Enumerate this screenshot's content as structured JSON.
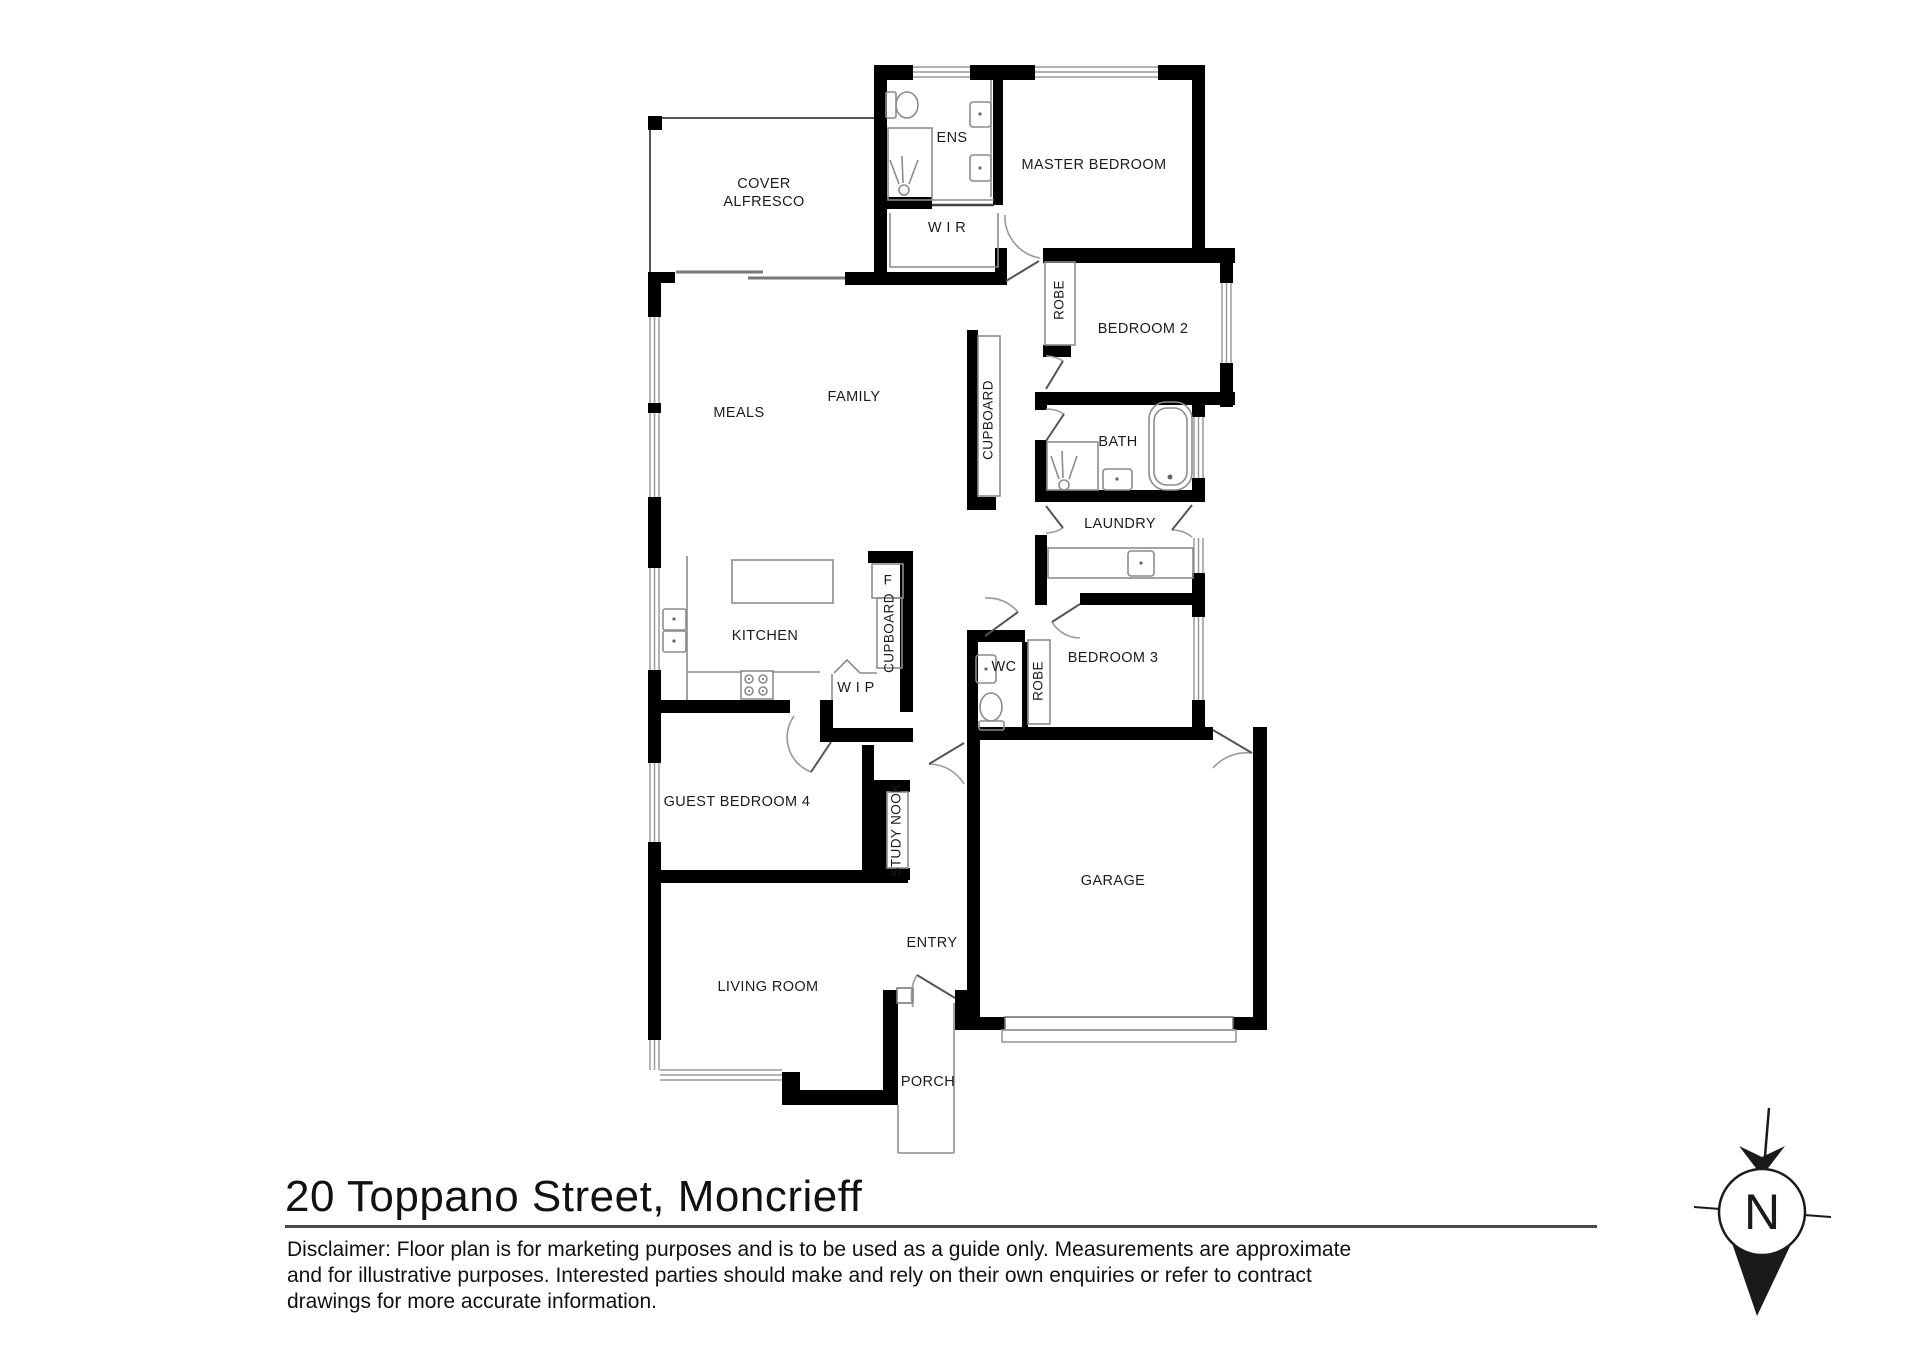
{
  "title": "20 Toppano Street, Moncrieff",
  "disclaimer": {
    "line1": "Disclaimer: Floor plan is for marketing purposes and is to be used as a guide only. Measurements  are approximate",
    "line2": "and for illustrative purposes. Interested parties should make and rely on their own enquiries or refer to contract",
    "line3": "drawings for more accurate information."
  },
  "compass": {
    "label": "N"
  },
  "rooms": {
    "cover_alfresco": "COVER\nALFRESCO",
    "ens": "ENS",
    "master_bedroom": "MASTER BEDROOM",
    "wir": "W I R",
    "robe_bedroom2": "ROBE",
    "bedroom2": "BEDROOM 2",
    "cupboard_hall": "CUPBOARD",
    "meals": "MEALS",
    "family": "FAMILY",
    "bath": "BATH",
    "laundry": "LAUNDRY",
    "kitchen": "KITCHEN",
    "fridge": "F",
    "cupboard_kitchen": "CUPBOARD",
    "wip": "W I P",
    "wc": "WC",
    "robe_bedroom3": "ROBE",
    "bedroom3": "BEDROOM 3",
    "guest_bedroom4": "GUEST BEDROOM 4",
    "study_nook": "STUDY NOOK",
    "garage": "GARAGE",
    "entry": "ENTRY",
    "living_room": "LIVING ROOM",
    "porch": "PORCH"
  },
  "colors": {
    "wall": "#000000",
    "fixture_line": "#8c8c8c",
    "text": "#1c1c1c"
  }
}
